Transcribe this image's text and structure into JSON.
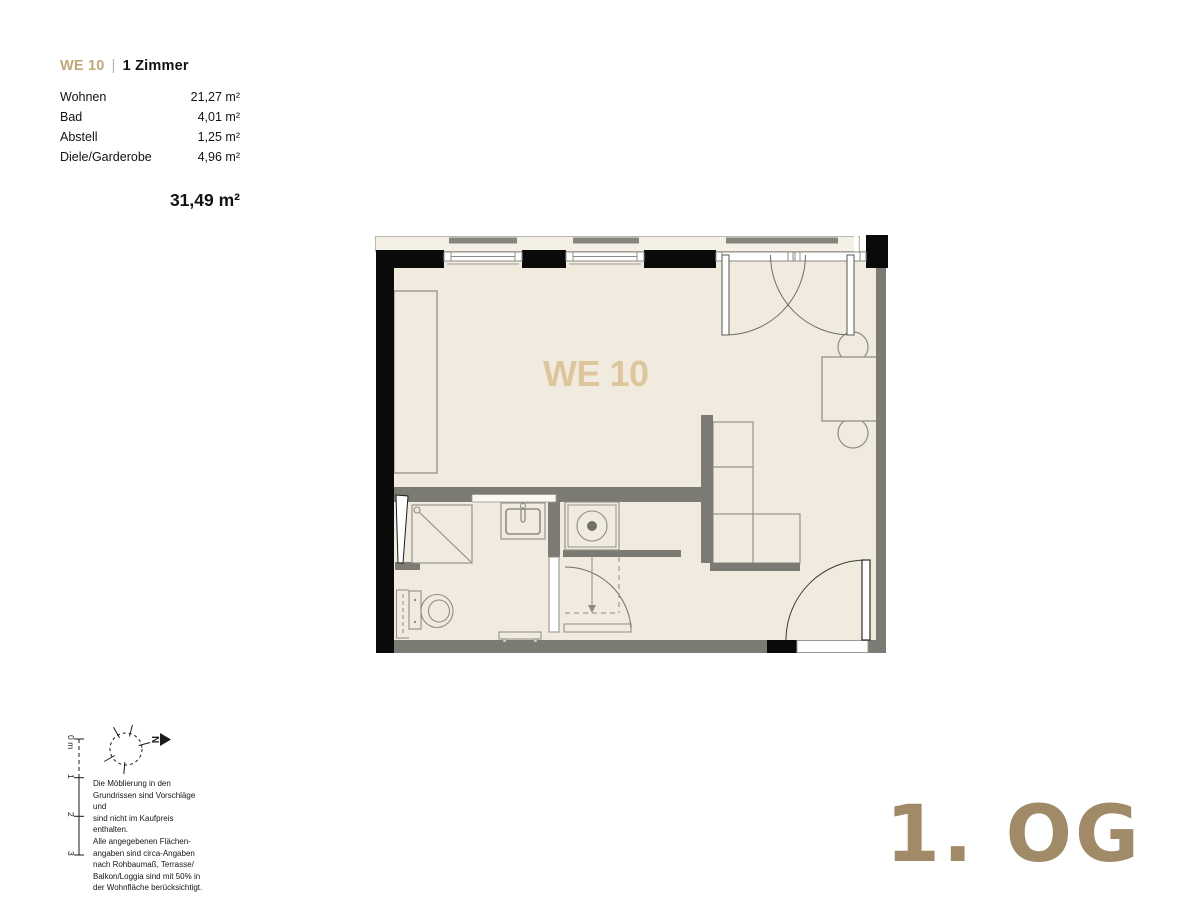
{
  "header": {
    "unit_id": "WE 10",
    "separator": "|",
    "unit_type": "1 Zimmer",
    "rooms": [
      {
        "label": "Wohnen",
        "area": "21,27 m²"
      },
      {
        "label": "Bad",
        "area": "4,01 m²"
      },
      {
        "label": "Abstell",
        "area": "1,25 m²"
      },
      {
        "label": "Diele/Garderobe",
        "area": "4,96 m²"
      }
    ],
    "total_area": "31,49 m²"
  },
  "plan": {
    "label": "WE 10"
  },
  "scale_bar": {
    "labels": [
      "0 m",
      "1",
      "2",
      "3"
    ]
  },
  "north_arrow": {
    "letter": "N"
  },
  "disclaimer": {
    "lines": [
      "Die Möblierung in den",
      "Grundrissen sind Vorschläge und",
      "sind nicht im Kaufpreis enthalten.",
      "Alle angegebenen Flächen-",
      "angaben sind circa-Angaben",
      "nach Rohbaumaß, Terrasse/",
      "Balkon/Loggia sind mit 50% in",
      "der Wohnfläche berücksichtigt."
    ]
  },
  "floor_label": "1. OG",
  "colors": {
    "accent_tan": "#bfa878",
    "plan_label_tan": "#ddc69e",
    "floor_label_brown": "#a08a68",
    "wall_black": "#0a0a0a",
    "wall_gray": "#7b7b74",
    "floor_cream": "#f1ebdf",
    "line_gray": "#8c8c84"
  }
}
